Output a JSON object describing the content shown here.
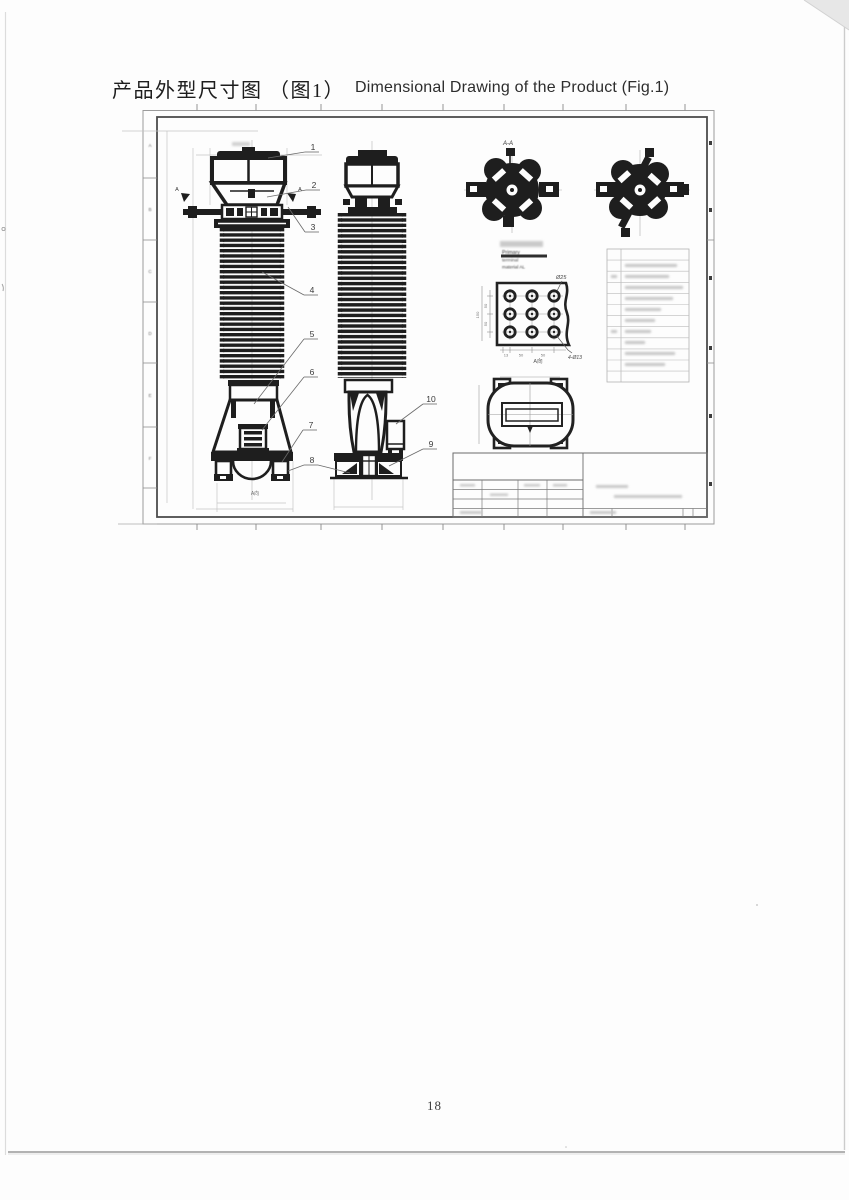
{
  "page": {
    "title_zh": "产品外型尺寸图 （图1）",
    "title_en": "Dimensional Drawing of the Product (Fig.1)",
    "page_number": "18"
  },
  "drawing": {
    "zone_letters": [
      "A",
      "B",
      "C",
      "D",
      "E",
      "F"
    ],
    "callouts": [
      "1",
      "2",
      "3",
      "4",
      "5",
      "6",
      "7",
      "8",
      "9",
      "10"
    ],
    "section_label": "A-A",
    "section_marker_left": "A",
    "section_marker_right": "A",
    "view_label_bottom": "A向",
    "note": {
      "line1": "Primary",
      "line2": "terminal",
      "line3": "material AL"
    },
    "terminal_plate": {
      "hole_dia": "Ø25",
      "hole_count_note": "4-Ø13",
      "view_label": "A向",
      "dim_left_1": "50",
      "dim_left_2": "50",
      "dim_left_total": "150",
      "dim_bottom_1": "13",
      "dim_bottom_2": "50",
      "dim_bottom_3": "50"
    }
  }
}
